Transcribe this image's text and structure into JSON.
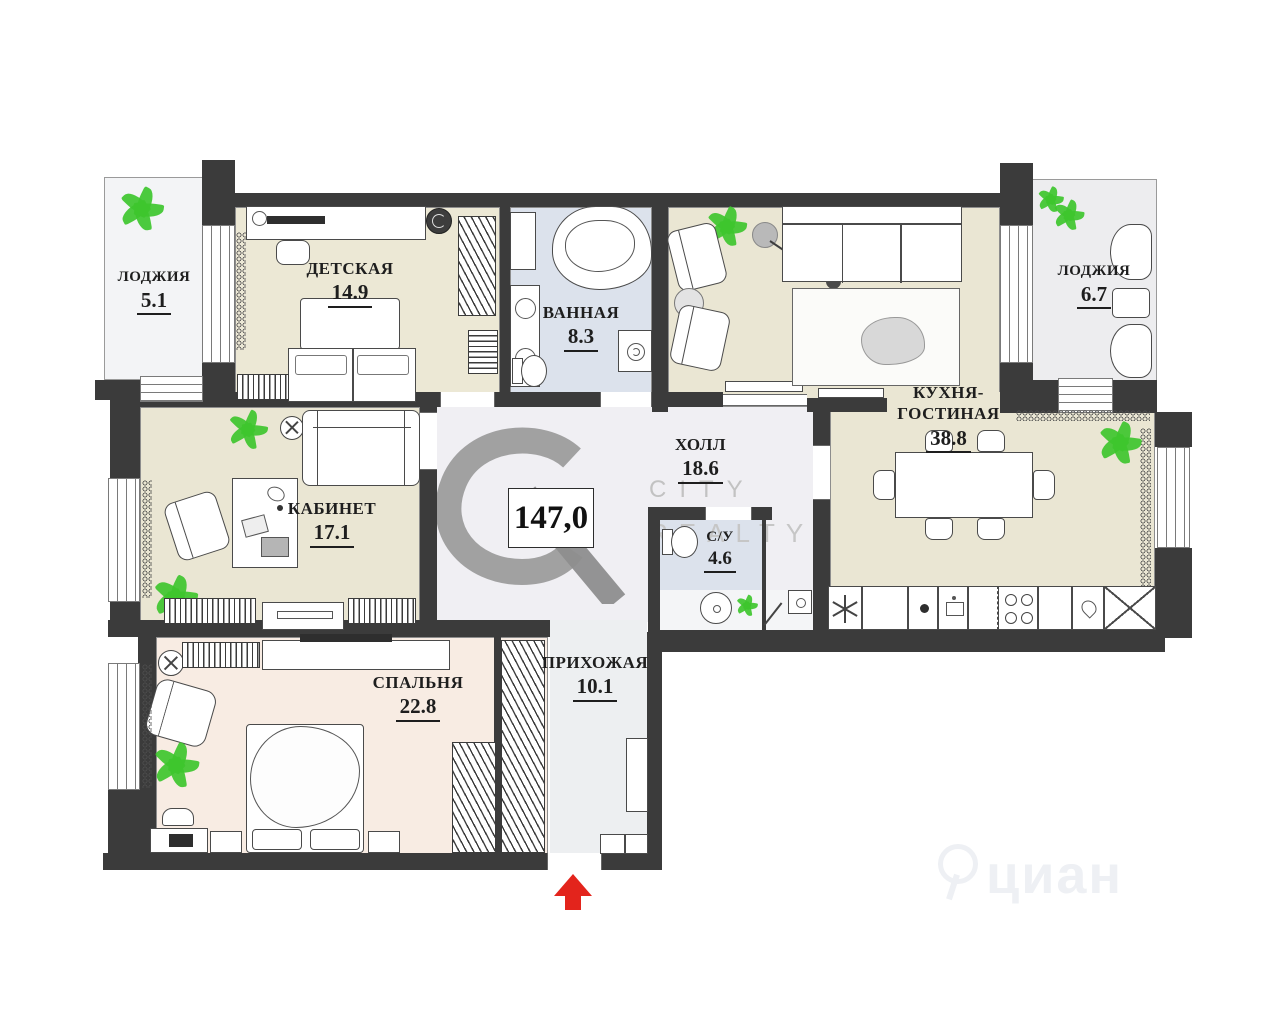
{
  "total_area_label": "147,0",
  "rooms": {
    "loggia_left": {
      "name": "ЛОДЖИЯ",
      "area": "5.1"
    },
    "nursery": {
      "name": "ДЕТСКАЯ",
      "area": "14.9"
    },
    "bathroom": {
      "name": "ВАННАЯ",
      "area": "8.3"
    },
    "loggia_right": {
      "name": "ЛОДЖИЯ",
      "area": "6.7"
    },
    "kitchen_living": {
      "name_line1": "КУХНЯ-",
      "name_line2": "ГОСТИНАЯ",
      "area": "38.8"
    },
    "study": {
      "name": "КАБИНЕТ",
      "area": "17.1"
    },
    "hall": {
      "name": "ХОЛЛ",
      "area": "18.6"
    },
    "wc": {
      "name": "С/У",
      "area": "4.6"
    },
    "bedroom": {
      "name": "СПАЛЬНЯ",
      "area": "22.8"
    },
    "entry": {
      "name": "ПРИХОЖАЯ",
      "area": "10.1"
    }
  },
  "watermarks": {
    "logo_monogram": "CR",
    "line1": "CITY",
    "line2": "REALTY",
    "corner": "циан"
  },
  "icons": {
    "entrance_arrow": "up-arrow"
  },
  "colors": {
    "wall": "#3b3b3b",
    "beige_floor": "#eae6d3",
    "nursery_floor": "#ece8d5",
    "bath_floor": "#dce2ec",
    "hall_floor": "#f0eff3",
    "entry_floor": "#edeff1",
    "bedroom_floor": "#f8ece3",
    "loggia_floor": "#f3f4f6",
    "accent_red": "#e3241c",
    "plant_green": "#3ec52e",
    "watermark_gray": "#9c9c9c"
  }
}
